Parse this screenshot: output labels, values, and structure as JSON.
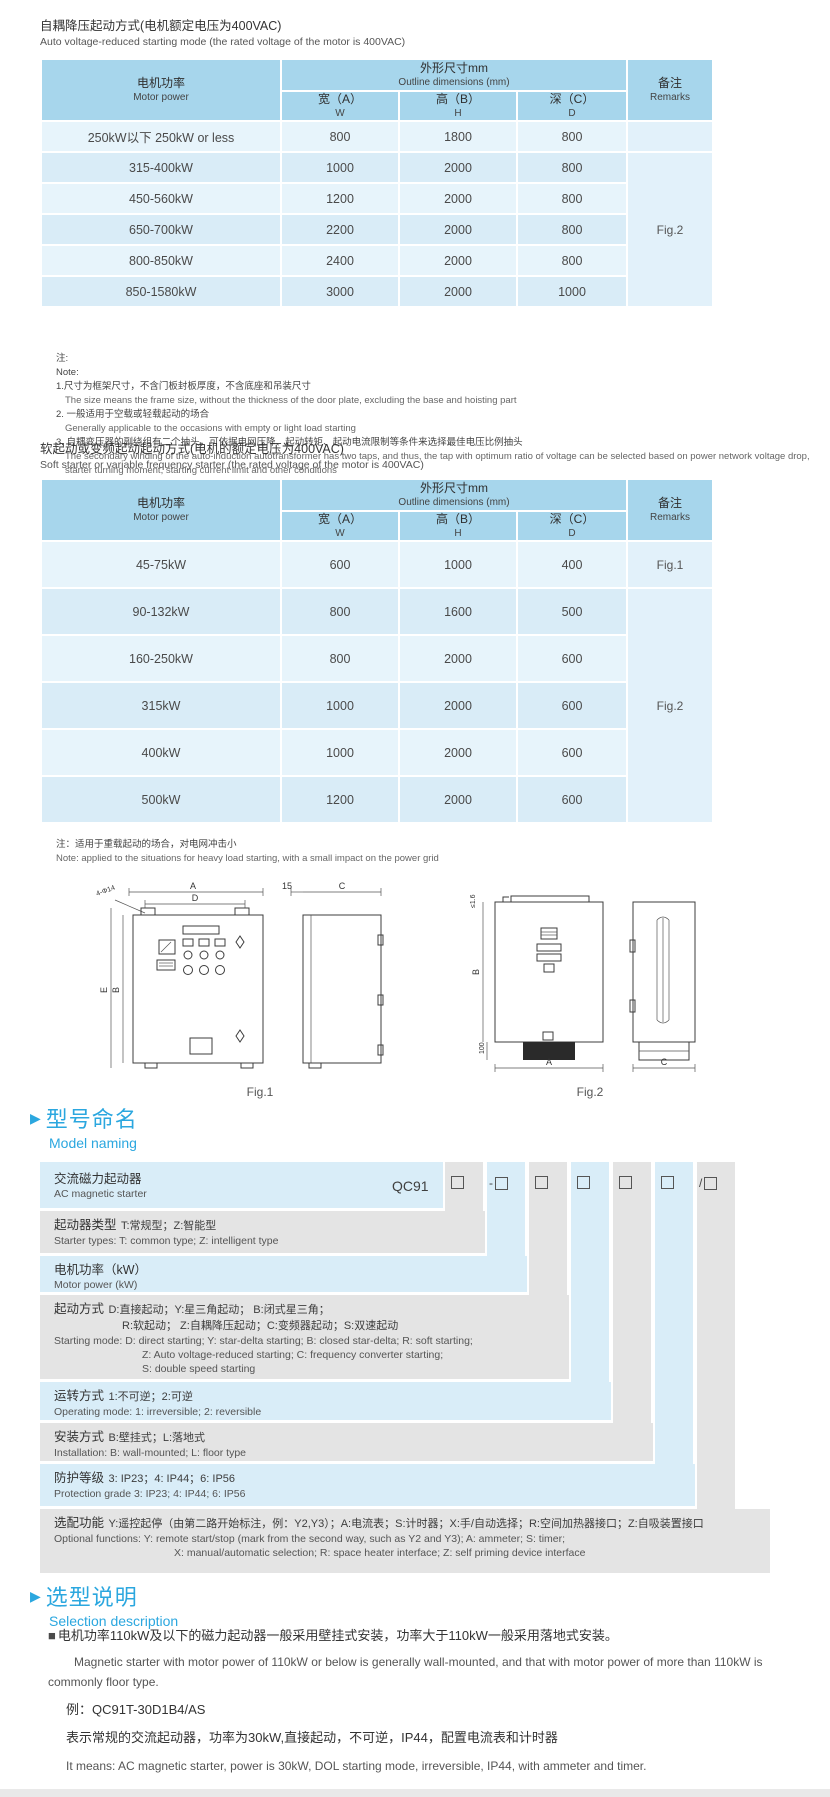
{
  "ui": {
    "section_marker": "▶",
    "bullet": "■"
  },
  "table1": {
    "title_zh": "自耦降压起动方式(电机额定电压为400VAC)",
    "title_en": "Auto voltage-reduced starting mode (the rated voltage of the motor is 400VAC)",
    "header": {
      "motor_zh": "电机功率",
      "motor_en": "Motor power",
      "dims_zh": "外形尺寸mm",
      "dims_en": "Outline dimensions (mm)",
      "w_zh": "宽（A）",
      "w_en": "W",
      "h_zh": "高（B）",
      "h_en": "H",
      "d_zh": "深（C）",
      "d_en": "D",
      "remarks_zh": "备注",
      "remarks_en": "Remarks"
    },
    "rows": [
      {
        "power": "250kW以下 250kW or less",
        "w": "800",
        "h": "1800",
        "d": "800"
      },
      {
        "power": "315-400kW",
        "w": "1000",
        "h": "2000",
        "d": "800"
      },
      {
        "power": "450-560kW",
        "w": "1200",
        "h": "2000",
        "d": "800"
      },
      {
        "power": "650-700kW",
        "w": "2200",
        "h": "2000",
        "d": "800"
      },
      {
        "power": "800-850kW",
        "w": "2400",
        "h": "2000",
        "d": "800"
      },
      {
        "power": "850-1580kW",
        "w": "3000",
        "h": "2000",
        "d": "1000"
      }
    ],
    "remark_row1": "",
    "remark_merged": "Fig.2"
  },
  "notes1": {
    "lines": [
      "注:",
      "Note:",
      "1.尺寸为框架尺寸，不含门板封板厚度，不含底座和吊装尺寸",
      "The size means the frame size, without the thickness of the door plate, excluding the base and hoisting part",
      "2. 一般适用于空载或轻载起动的场合",
      "Generally applicable to the occasions with empty or light load starting",
      "3. 自耦变压器的副绕组有二个抽头，可依据电网压降、起动转矩、起动电流限制等条件来选择最佳电压比例抽头",
      "The secondary winding of the auto-induction autotransformer has two taps, and thus, the tap with optimum ratio of voltage can be selected based on power network voltage drop,",
      "starter turning moment, starting current limit and other conditions"
    ]
  },
  "table2": {
    "title_zh": "软起动或变频起动起动方式(电机的额定电压为400VAC)",
    "title_en": "Soft starter or variable frequency starter (the rated voltage of the motor is 400VAC)",
    "rows": [
      {
        "power": "45-75kW",
        "w": "600",
        "h": "1000",
        "d": "400"
      },
      {
        "power": "90-132kW",
        "w": "800",
        "h": "1600",
        "d": "500"
      },
      {
        "power": "160-250kW",
        "w": "800",
        "h": "2000",
        "d": "600"
      },
      {
        "power": "315kW",
        "w": "1000",
        "h": "2000",
        "d": "600"
      },
      {
        "power": "400kW",
        "w": "1000",
        "h": "2000",
        "d": "600"
      },
      {
        "power": "500kW",
        "w": "1200",
        "h": "2000",
        "d": "600"
      }
    ],
    "remark_row1": "Fig.1",
    "remark_merged": "Fig.2",
    "note_zh": "注：适用于重载起动的场合，对电网冲击小",
    "note_en": "Note: applied to the situations for heavy load starting, with a small impact on the power grid"
  },
  "figures": {
    "fig1": {
      "caption": "Fig.1",
      "dim_a": "A",
      "dim_d": "D",
      "dim_hole": "4-Φ14",
      "dim_15": "15",
      "dim_c": "C",
      "dim_e": "E",
      "dim_b": "B"
    },
    "fig2": {
      "caption": "Fig.2",
      "dim_top": "≤1.6",
      "dim_b": "B",
      "dim_100": "100",
      "dim_a": "A",
      "dim_c": "C"
    }
  },
  "model_naming": {
    "section_zh": "型号命名",
    "section_en": "Model naming",
    "code_prefix": "QC91",
    "box_prefixes": [
      "",
      "-",
      "",
      "",
      "",
      "",
      "/"
    ],
    "rows": [
      {
        "zh": "交流磁力起动器",
        "en": "AC magnetic starter"
      },
      {
        "label": "起动器类型",
        "detail": "T:常规型；Z:智能型",
        "en": "Starter types: T: common type; Z: intelligent type"
      },
      {
        "label": "电机功率（kW）",
        "detail": "",
        "en": "Motor power (kW)"
      },
      {
        "label": "起动方式",
        "detail": "D:直接起动；Y:星三角起动；  B:闭式星三角；",
        "detail2": "R:软起动；  Z:自耦降压起动；C:变频器起动；S:双速起动",
        "en": "Starting mode: D: direct starting; Y: star-delta starting; B: closed star-delta; R: soft starting;",
        "en2": "Z: Auto voltage-reduced starting; C: frequency converter starting;",
        "en3": "S: double speed starting"
      },
      {
        "label": "运转方式",
        "detail": "1:不可逆；2:可逆",
        "en": "Operating mode: 1: irreversible; 2: reversible"
      },
      {
        "label": "安装方式",
        "detail": "B:壁挂式；L:落地式",
        "en": "Installation: B: wall-mounted;  L: floor type"
      },
      {
        "label": "防护等级",
        "detail": "3: IP23；4: IP44；6: IP56",
        "en": "Protection grade  3: IP23;  4: IP44;  6: IP56"
      },
      {
        "label": "选配功能",
        "detail": "Y:遥控起停（由第二路开始标注，例：Y2,Y3）；A:电流表；S:计时器；X:手/自动选择；R:空间加热器接口；Z:自吸装置接口",
        "en": "Optional functions: Y: remote start/stop (mark from the second way, such as Y2 and Y3); A: ammeter; S: timer;",
        "en2": "X: manual/automatic selection; R: space heater interface; Z: self priming device interface"
      }
    ]
  },
  "selection": {
    "section_zh": "选型说明",
    "section_en": "Selection description",
    "p1_zh": "电机功率110kW及以下的磁力起动器一般采用壁挂式安装，功率大于110kW一般采用落地式安装。",
    "p1_en": "Magnetic starter with motor power of 110kW or below is generally wall-mounted, and that with motor power of more than 110kW is commonly floor type.",
    "example": "例：QC91T-30D1B4/AS",
    "p2_zh": "表示常规的交流起动器，功率为30kW,直接起动，不可逆，IP44，配置电流表和计时器",
    "p2_en": "It means: AC magnetic starter, power is 30kW, DOL starting mode, irreversible, IP44, with ammeter and timer."
  }
}
